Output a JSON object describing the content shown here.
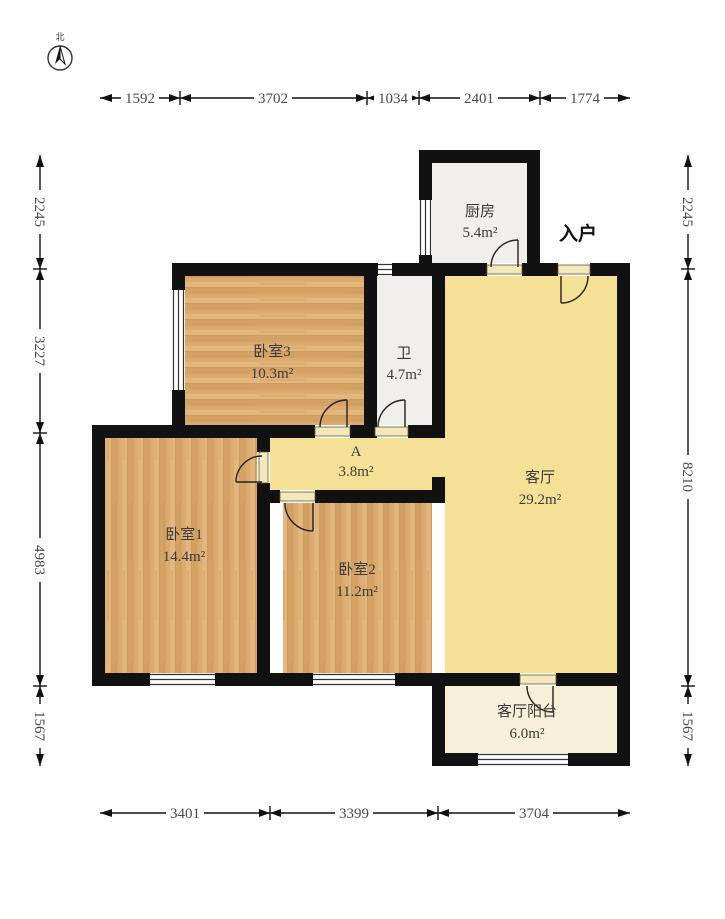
{
  "plan_title": "floor-plan",
  "compass": {
    "north_label": "北"
  },
  "entrance_label": "入户",
  "rooms": [
    {
      "id": "kitchen",
      "name": "厨房",
      "area": "5.4m²"
    },
    {
      "id": "bedroom3",
      "name": "卧室3",
      "area": "10.3m²"
    },
    {
      "id": "bath",
      "name": "卫",
      "area": "4.7m²"
    },
    {
      "id": "hall",
      "name": "A",
      "area": "3.8m²"
    },
    {
      "id": "living",
      "name": "客厅",
      "area": "29.2m²"
    },
    {
      "id": "bedroom1",
      "name": "卧室1",
      "area": "14.4m²"
    },
    {
      "id": "bedroom2",
      "name": "卧室2",
      "area": "11.2m²"
    },
    {
      "id": "balcony",
      "name": "客厅阳台",
      "area": "6.0m²"
    }
  ],
  "dimensions": {
    "top": [
      "1592",
      "3702",
      "1034",
      "2401",
      "1774"
    ],
    "bottom": [
      "3401",
      "3399",
      "3704"
    ],
    "left": [
      "2245",
      "3227",
      "4983",
      "1567"
    ],
    "right": [
      "2245",
      "8210",
      "1567"
    ]
  },
  "colors": {
    "wall": "#111111",
    "wood_floor": "#DBAB70",
    "living_floor": "#F5E195",
    "wet_floor": "#F0EFEB",
    "balcony_floor": "#F6F0D8"
  }
}
